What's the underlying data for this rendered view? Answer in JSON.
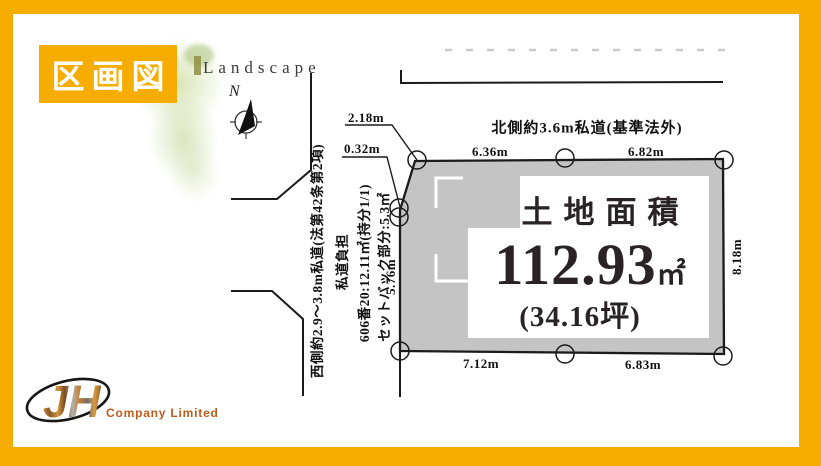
{
  "colors": {
    "accent": "#F6AD00",
    "plot_fill": "#C4C4C4",
    "line": "#1B1B1B",
    "logo_text": "#BF5B1D"
  },
  "badge": {
    "label": "区画図"
  },
  "decor": {
    "brand": "Landscape",
    "compass": "N"
  },
  "roads": {
    "north": "北側約3.6m私道(基準法外)",
    "west_lines": [
      "西側約2.9～3.8m私道(法第42条第2項)",
      "私道負担",
      "606番20:12.11㎡(持分1/1)",
      "セットバック部分:5.3㎡"
    ]
  },
  "area": {
    "title": "土地面積",
    "value": "112.93",
    "unit": "㎡",
    "tsubo": "(34.16坪)"
  },
  "dimensions": {
    "top_left": "6.36m",
    "top_right": "6.82m",
    "right_side": "8.18m",
    "left_side": "5.76m",
    "bottom_left": "7.12m",
    "bottom_right": "6.83m",
    "corner_upper": "2.18m",
    "corner_lower": "0.32m"
  },
  "logo": {
    "mark": "JH",
    "company": "Company Limited"
  }
}
